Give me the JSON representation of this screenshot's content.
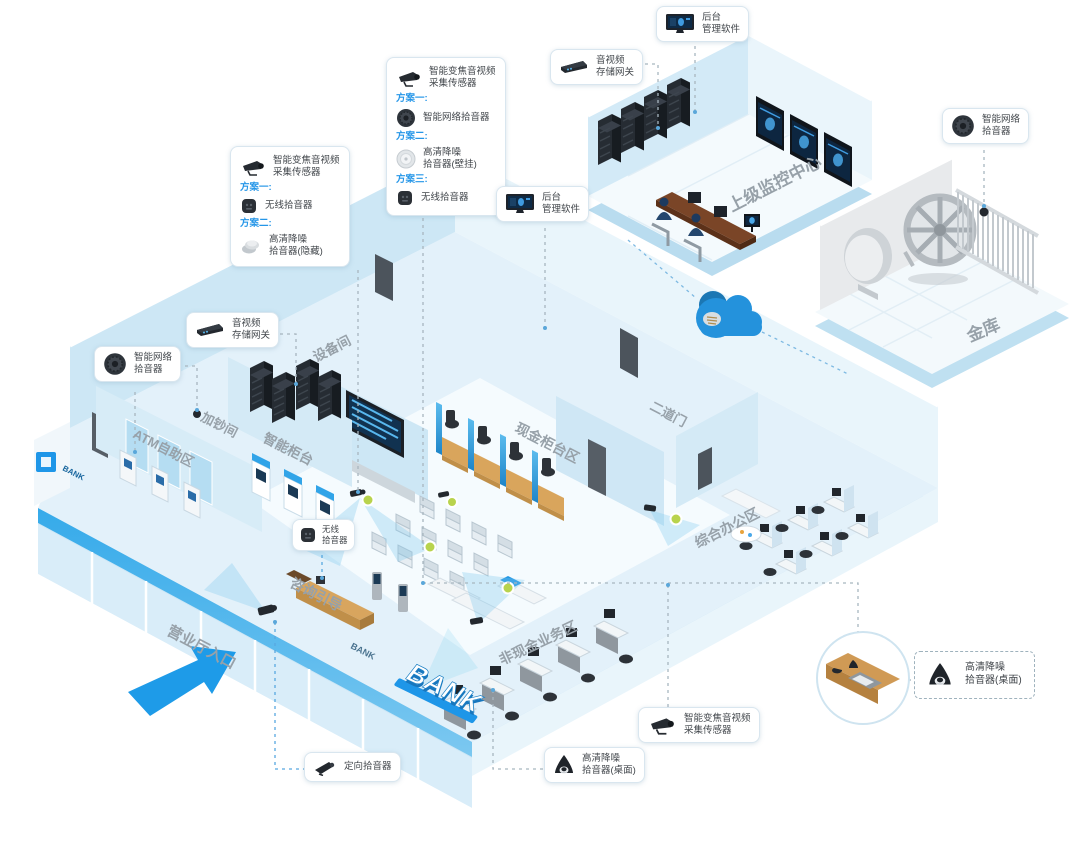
{
  "colors": {
    "accent": "#1e9be8"
  },
  "bank_sign": "BANK",
  "rooms": {
    "monitor_center": "上级监控中心",
    "vault": "金库",
    "equipment": "设备间",
    "cash_add": "加钞间",
    "atm": "ATM自助区",
    "smart_counter": "智能柜台",
    "cash_counter": "现金柜台区",
    "second_door": "二道门",
    "office": "综合办公区",
    "noncash": "非现金业务区",
    "consult": "咨询引导",
    "entrance": "营业厅入口"
  },
  "callouts": {
    "backend_top": {
      "line1": "后台",
      "line2": "管理软件"
    },
    "storage_top": {
      "line1": "音视频",
      "line2": "存储网关"
    },
    "backend_wall": {
      "line1": "后台",
      "line2": "管理软件"
    },
    "plan_box_top": {
      "title1": "智能变焦音视频",
      "title2": "采集传感器",
      "plan1": "方案一:",
      "item1": "智能网络拾音器",
      "plan2": "方案二:",
      "item2a": "高清降噪",
      "item2b": "拾音器(壁挂)",
      "plan3": "方案三:",
      "item3": "无线拾音器"
    },
    "plan_box_left": {
      "title1": "智能变焦音视频",
      "title2": "采集传感器",
      "plan1": "方案一:",
      "item1": "无线拾音器",
      "plan2": "方案二:",
      "item2a": "高清降噪",
      "item2b": "拾音器(隐藏)"
    },
    "storage_left": {
      "line1": "音视频",
      "line2": "存储网关"
    },
    "network_left": {
      "line1": "智能网络",
      "line2": "拾音器"
    },
    "network_vault": {
      "line1": "智能网络",
      "line2": "拾音器"
    },
    "wireless_hall": {
      "line1": "无线",
      "line2": "拾音器"
    },
    "directional": {
      "label": "定向拾音器"
    },
    "desktop_bottom": {
      "line1": "高清降噪",
      "line2": "拾音器(桌面)"
    },
    "zoom_sensor_bottom": {
      "line1": "智能变焦音视频",
      "line2": "采集传感器"
    },
    "desktop_right": {
      "line1": "高清降噪",
      "line2": "拾音器(桌面)"
    }
  }
}
